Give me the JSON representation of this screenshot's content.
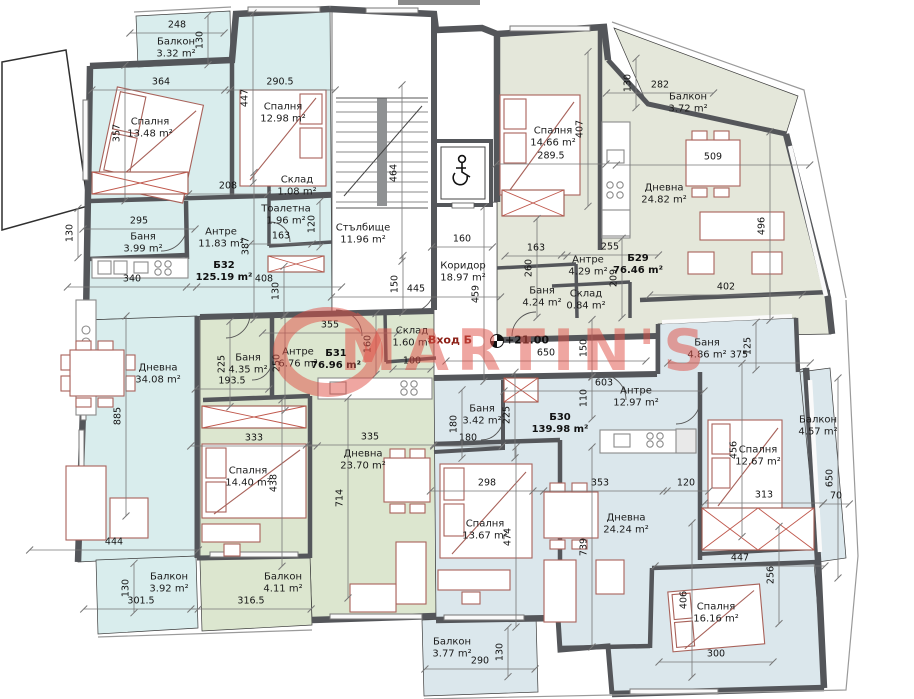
{
  "watermark": {
    "text": "MARTIN'S"
  },
  "entrance": {
    "label": "Вход Б",
    "elevation": "+21.00"
  },
  "colors": {
    "wall": "#54565a",
    "b32": "#d9eded",
    "b31": "#dce6cf",
    "b30": "#dbe7ec",
    "b29": "#e4e7da",
    "furn": "#a8625a",
    "wm": "#e05046",
    "dimline": "#777777"
  },
  "units": [
    {
      "id": "Б32",
      "area": "125.19 m²",
      "x": 224,
      "y": 272
    },
    {
      "id": "Б31",
      "area": "76.96 m²",
      "x": 336,
      "y": 360
    },
    {
      "id": "Б30",
      "area": "139.98 m²",
      "x": 560,
      "y": 424
    },
    {
      "id": "Б29",
      "area": "76.46 m²",
      "x": 638,
      "y": 265
    }
  ],
  "rooms": [
    {
      "unit": "Б32",
      "name": "Балкон",
      "area": "3.32 m²",
      "x": 176,
      "y": 48
    },
    {
      "unit": "Б32",
      "name": "Спалня",
      "area": "13.48 m²",
      "x": 150,
      "y": 128
    },
    {
      "unit": "Б32",
      "name": "Спалня",
      "area": "12.98 m²",
      "x": 283,
      "y": 113
    },
    {
      "unit": "Б32",
      "name": "Баня",
      "area": "3.99 m²",
      "x": 143,
      "y": 243
    },
    {
      "unit": "Б32",
      "name": "Антре",
      "area": "11.83 m²",
      "x": 221,
      "y": 238
    },
    {
      "unit": "Б32",
      "name": "Склад",
      "area": "1.08 m²",
      "x": 297,
      "y": 186
    },
    {
      "unit": "Б32",
      "name": "Тоалетна",
      "area": "1.96 m²",
      "x": 286,
      "y": 215
    },
    {
      "unit": "Б32",
      "name": "Дневна",
      "area": "34.08 m²",
      "x": 158,
      "y": 374
    },
    {
      "unit": "Б32",
      "name": "Балкон",
      "area": "3.92 m²",
      "x": 169,
      "y": 583
    },
    {
      "unit": "общи",
      "name": "Стълбище",
      "area": "11.96 m²",
      "x": 363,
      "y": 234
    },
    {
      "unit": "общи",
      "name": "Коридор",
      "area": "18.97 m²",
      "x": 463,
      "y": 272
    },
    {
      "unit": "Б29",
      "name": "Спалня",
      "area": "14.66 m²",
      "x": 553,
      "y": 137
    },
    {
      "unit": "Б29",
      "name": "Балкон",
      "area": "3.72 m²",
      "x": 688,
      "y": 103
    },
    {
      "unit": "Б29",
      "name": "Дневна",
      "area": "24.82 m²",
      "x": 664,
      "y": 194
    },
    {
      "unit": "Б29",
      "name": "Антре",
      "area": "4.29 m²",
      "x": 588,
      "y": 266
    },
    {
      "unit": "Б29",
      "name": "Баня",
      "area": "4.24 m²",
      "x": 542,
      "y": 297
    },
    {
      "unit": "Б29",
      "name": "Склад",
      "area": "0.84 m²",
      "x": 586,
      "y": 300
    },
    {
      "unit": "Б31",
      "name": "Баня",
      "area": "4.35 m²",
      "x": 248,
      "y": 364
    },
    {
      "unit": "Б31",
      "name": "Антре",
      "area": "6.76 m²",
      "x": 298,
      "y": 358
    },
    {
      "unit": "Б31",
      "name": "Склад",
      "area": "1.60 m²",
      "x": 412,
      "y": 337
    },
    {
      "unit": "Б31",
      "name": "Спалня",
      "area": "14.40 m²",
      "x": 248,
      "y": 477
    },
    {
      "unit": "Б31",
      "name": "Дневна",
      "area": "23.70 m²",
      "x": 363,
      "y": 460
    },
    {
      "unit": "Б31",
      "name": "Балкон",
      "area": "4.11 m²",
      "x": 283,
      "y": 583
    },
    {
      "unit": "Б30",
      "name": "Баня",
      "area": "3.42 m²",
      "x": 482,
      "y": 415
    },
    {
      "unit": "Б30",
      "name": "Антре",
      "area": "12.97 m²",
      "x": 636,
      "y": 397
    },
    {
      "unit": "Б30",
      "name": "Баня",
      "area": "4.86 m²",
      "x": 707,
      "y": 349
    },
    {
      "unit": "Б30",
      "name": "Спалня",
      "area": "12.67 m²",
      "x": 758,
      "y": 456
    },
    {
      "unit": "Б30",
      "name": "Балкон",
      "area": "4.57 m²",
      "x": 818,
      "y": 426
    },
    {
      "unit": "Б30",
      "name": "Спалня",
      "area": "13.67 m²",
      "x": 485,
      "y": 530
    },
    {
      "unit": "Б30",
      "name": "Дневна",
      "area": "24.24 m²",
      "x": 626,
      "y": 524
    },
    {
      "unit": "Б30",
      "name": "Спалня",
      "area": "16.16 m²",
      "x": 716,
      "y": 613
    },
    {
      "unit": "Б30",
      "name": "Балкон",
      "area": "3.77 m²",
      "x": 452,
      "y": 648
    }
  ],
  "dims": [
    {
      "t": "248",
      "x": 177,
      "y": 25,
      "v": false
    },
    {
      "t": "130",
      "x": 200,
      "y": 40,
      "v": true
    },
    {
      "t": "364",
      "x": 161,
      "y": 82,
      "v": false
    },
    {
      "t": "290.5",
      "x": 280,
      "y": 82,
      "v": false
    },
    {
      "t": "447",
      "x": 245,
      "y": 98,
      "v": true
    },
    {
      "t": "357",
      "x": 117,
      "y": 133,
      "v": true
    },
    {
      "t": "208",
      "x": 228,
      "y": 186,
      "v": false
    },
    {
      "t": "295",
      "x": 139,
      "y": 221,
      "v": false
    },
    {
      "t": "130",
      "x": 70,
      "y": 233,
      "v": true
    },
    {
      "t": "340",
      "x": 132,
      "y": 279,
      "v": false
    },
    {
      "t": "387",
      "x": 246,
      "y": 246,
      "v": true
    },
    {
      "t": "408",
      "x": 264,
      "y": 279,
      "v": false
    },
    {
      "t": "130",
      "x": 276,
      "y": 291,
      "v": true
    },
    {
      "t": "163",
      "x": 281,
      "y": 236,
      "v": false
    },
    {
      "t": "120",
      "x": 312,
      "y": 224,
      "v": true
    },
    {
      "t": "464",
      "x": 394,
      "y": 173,
      "v": true
    },
    {
      "t": "160",
      "x": 462,
      "y": 239,
      "v": false
    },
    {
      "t": "150",
      "x": 395,
      "y": 284,
      "v": true
    },
    {
      "t": "445",
      "x": 416,
      "y": 289,
      "v": false
    },
    {
      "t": "459",
      "x": 476,
      "y": 294,
      "v": true
    },
    {
      "t": "407",
      "x": 580,
      "y": 129,
      "v": true
    },
    {
      "t": "289.5",
      "x": 551,
      "y": 156,
      "v": false
    },
    {
      "t": "130",
      "x": 628,
      "y": 83,
      "v": true
    },
    {
      "t": "282",
      "x": 660,
      "y": 85,
      "v": false
    },
    {
      "t": "509",
      "x": 713,
      "y": 157,
      "v": false
    },
    {
      "t": "496",
      "x": 762,
      "y": 226,
      "v": true
    },
    {
      "t": "255",
      "x": 610,
      "y": 247,
      "v": false
    },
    {
      "t": "163",
      "x": 536,
      "y": 248,
      "v": false
    },
    {
      "t": "260",
      "x": 529,
      "y": 268,
      "v": true
    },
    {
      "t": "209",
      "x": 614,
      "y": 278,
      "v": true
    },
    {
      "t": "402",
      "x": 726,
      "y": 287,
      "v": false
    },
    {
      "t": "225",
      "x": 222,
      "y": 364,
      "v": true
    },
    {
      "t": "250",
      "x": 277,
      "y": 363,
      "v": true
    },
    {
      "t": "193.5",
      "x": 232,
      "y": 381,
      "v": false
    },
    {
      "t": "355",
      "x": 330,
      "y": 325,
      "v": false
    },
    {
      "t": "160",
      "x": 368,
      "y": 344,
      "v": true
    },
    {
      "t": "100",
      "x": 412,
      "y": 361,
      "v": false
    },
    {
      "t": "650",
      "x": 546,
      "y": 353,
      "v": false
    },
    {
      "t": "150",
      "x": 584,
      "y": 348,
      "v": true
    },
    {
      "t": "603",
      "x": 604,
      "y": 383,
      "v": false
    },
    {
      "t": "110",
      "x": 584,
      "y": 398,
      "v": true
    },
    {
      "t": "180",
      "x": 454,
      "y": 424,
      "v": true
    },
    {
      "t": "180",
      "x": 468,
      "y": 438,
      "v": false
    },
    {
      "t": "225",
      "x": 507,
      "y": 415,
      "v": true
    },
    {
      "t": "333",
      "x": 254,
      "y": 438,
      "v": false
    },
    {
      "t": "438",
      "x": 274,
      "y": 483,
      "v": true
    },
    {
      "t": "885",
      "x": 118,
      "y": 416,
      "v": true
    },
    {
      "t": "444",
      "x": 114,
      "y": 542,
      "v": false
    },
    {
      "t": "714",
      "x": 340,
      "y": 498,
      "v": true
    },
    {
      "t": "335",
      "x": 370,
      "y": 437,
      "v": false
    },
    {
      "t": "298",
      "x": 487,
      "y": 483,
      "v": false
    },
    {
      "t": "474",
      "x": 508,
      "y": 537,
      "v": true
    },
    {
      "t": "353",
      "x": 600,
      "y": 483,
      "v": false
    },
    {
      "t": "739",
      "x": 584,
      "y": 547,
      "v": true
    },
    {
      "t": "120",
      "x": 686,
      "y": 483,
      "v": false
    },
    {
      "t": "125",
      "x": 748,
      "y": 346,
      "v": true
    },
    {
      "t": "375",
      "x": 739,
      "y": 355,
      "v": false
    },
    {
      "t": "456",
      "x": 734,
      "y": 450,
      "v": true
    },
    {
      "t": "313",
      "x": 764,
      "y": 495,
      "v": false
    },
    {
      "t": "650",
      "x": 830,
      "y": 478,
      "v": true
    },
    {
      "t": "70",
      "x": 836,
      "y": 496,
      "v": false
    },
    {
      "t": "447",
      "x": 740,
      "y": 558,
      "v": false
    },
    {
      "t": "256",
      "x": 771,
      "y": 575,
      "v": true
    },
    {
      "t": "406",
      "x": 684,
      "y": 600,
      "v": true
    },
    {
      "t": "300",
      "x": 716,
      "y": 654,
      "v": false
    },
    {
      "t": "301.5",
      "x": 141,
      "y": 601,
      "v": false
    },
    {
      "t": "130",
      "x": 126,
      "y": 588,
      "v": true
    },
    {
      "t": "316.5",
      "x": 251,
      "y": 601,
      "v": false
    },
    {
      "t": "290",
      "x": 480,
      "y": 661,
      "v": false
    },
    {
      "t": "130",
      "x": 500,
      "y": 652,
      "v": true
    }
  ]
}
